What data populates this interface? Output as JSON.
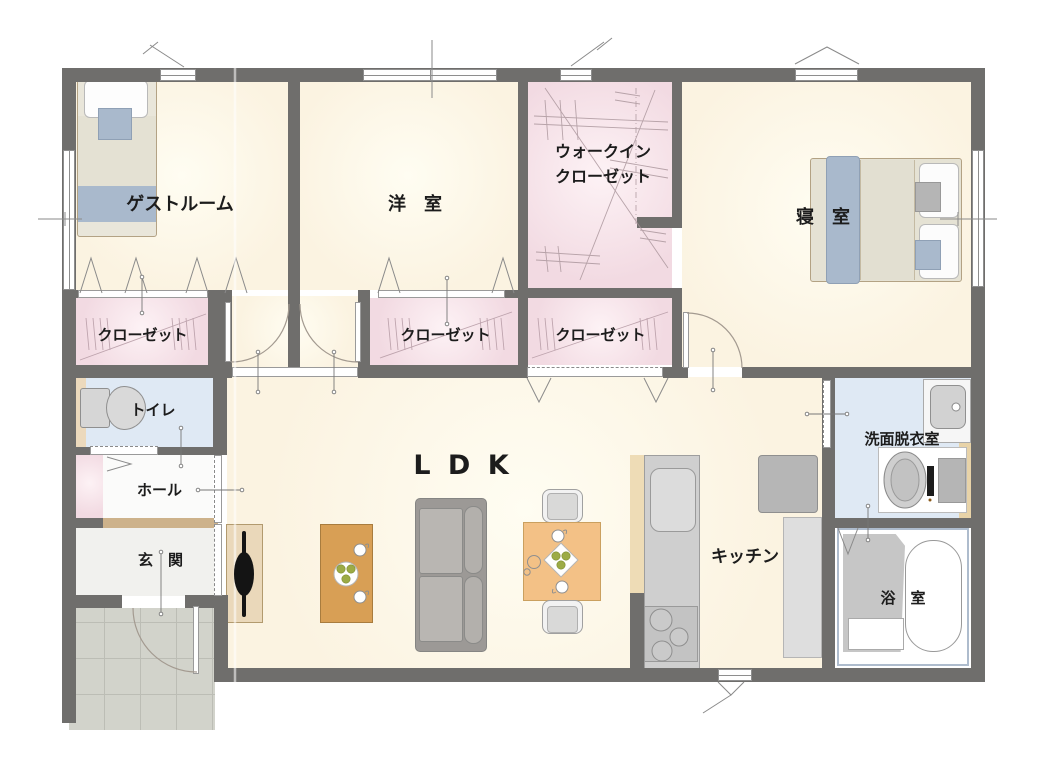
{
  "rooms": {
    "guest_room": {
      "label": "ゲストルーム"
    },
    "western_room": {
      "label": "洋　室"
    },
    "walk_in_closet": {
      "line1": "ウォークイン",
      "line2": "クローゼット"
    },
    "bedroom": {
      "label": "寝　室"
    },
    "closet_left": {
      "label": "クローゼット"
    },
    "closet_mid": {
      "label": "クローゼット"
    },
    "closet_right": {
      "label": "クローゼット"
    },
    "toilet": {
      "label": "トイレ"
    },
    "hall": {
      "label": "ホール"
    },
    "entrance": {
      "label": "玄　関"
    },
    "ldk": {
      "label": "L D K"
    },
    "kitchen": {
      "label": "キッチン"
    },
    "washroom": {
      "label": "洗面脱衣室"
    },
    "bathroom": {
      "label": "浴　室"
    }
  },
  "furniture_icons": [
    "single-bed",
    "double-bed",
    "pillow",
    "cushion",
    "sofa",
    "tv-board",
    "tv",
    "coffee-table",
    "dining-table",
    "dining-chair",
    "teacup",
    "plate-with-fruit",
    "kitchen-counter",
    "kitchen-sink",
    "stove",
    "refrigerator",
    "cupboard",
    "toilet",
    "vanity-sink",
    "washing-machine",
    "bathtub",
    "shower-area",
    "entrance-door",
    "swing-door",
    "sliding-door",
    "bifold-door",
    "window"
  ],
  "colors": {
    "wall": "#6f6e6c",
    "floor_cream": "#fbf3e1",
    "floor_pink": "#f2dae2",
    "floor_blue": "#dfe9f4",
    "floor_white": "#fbfbfa",
    "porch_tile": "#d2d3cb",
    "wood_dark_tan": "#d89f55",
    "wood_light_tan": "#f3c186",
    "tv_board_tan": "#ead8ba",
    "counter_gray": "#cfcfcf",
    "sofa_gray": "#a8a5a1",
    "bed_blue_gray": "#a9b9cc",
    "line_gray": "#8e8e8e"
  }
}
